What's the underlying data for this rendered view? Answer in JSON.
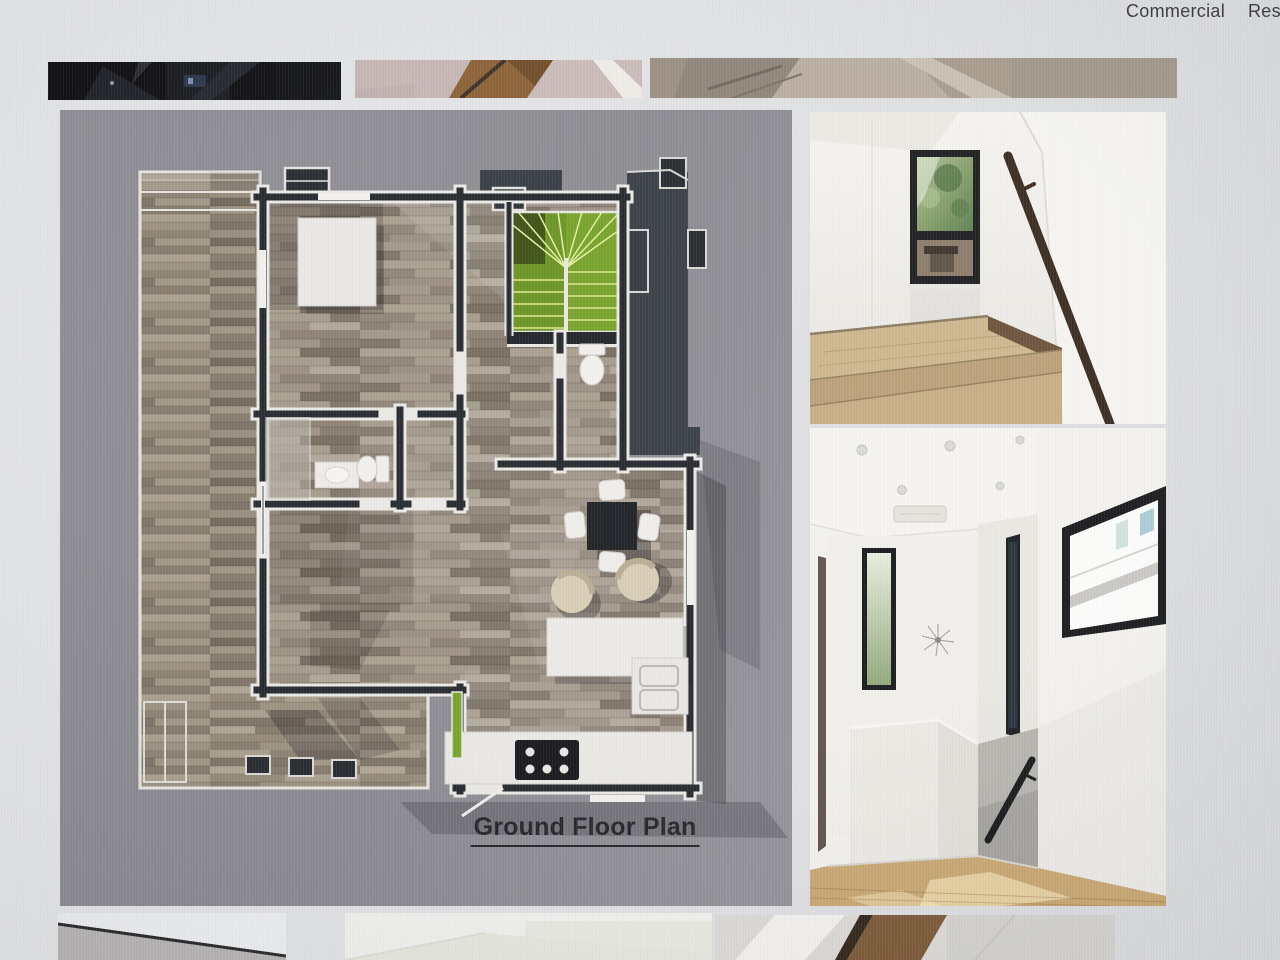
{
  "nav": {
    "items": [
      {
        "id": "commercial",
        "label": "Commercial"
      },
      {
        "id": "residential",
        "label": "Residential"
      }
    ]
  },
  "plan_panel": {
    "caption": "Ground Floor Plan"
  },
  "gallery": {
    "top_thumbnails": [
      {
        "name": "dark-interior-thumbnail"
      },
      {
        "name": "wood-stair-carpet-thumbnail"
      },
      {
        "name": "carpeted-stairwell-thumbnail"
      }
    ],
    "side_photos": [
      {
        "name": "stair-landing-window-photo"
      },
      {
        "name": "upstairs-hallway-photo"
      }
    ],
    "bottom_thumbnails": [
      {
        "name": "ceiling-line-thumbnail"
      },
      {
        "name": "pale-interior-thumbnail"
      },
      {
        "name": "stair-beam-thumbnail"
      }
    ]
  },
  "colors": {
    "page_bg": "#e2e3e5",
    "plan_bg": "#8d8c92",
    "wall_dark": "#22262b",
    "roof_dark": "#363c42",
    "stair_green": "#76a227",
    "wood_floor": "#998e80",
    "deck_wood": "#9a8f7e",
    "trim_white": "#ebeae6",
    "nav_text": "#3a3a3c",
    "caption_text": "#232327"
  }
}
